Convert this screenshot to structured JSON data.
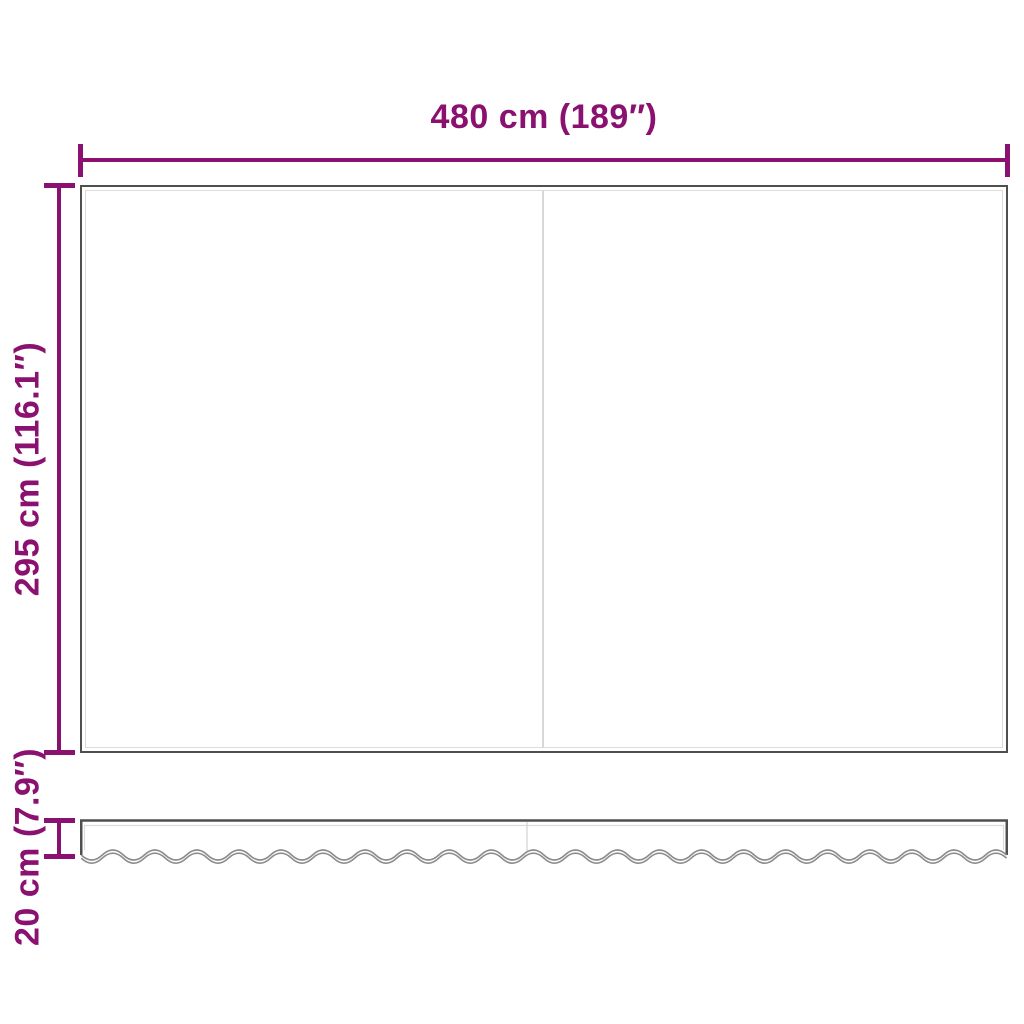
{
  "colors": {
    "accent": "#8a116f",
    "outline": "#4f4f4f",
    "inner_line": "#dcdcdc",
    "seam": "#d8d8d8",
    "wave": "#8c8c8c",
    "background": "#ffffff"
  },
  "labels": {
    "width": "480 cm (189″)",
    "height": "295 cm (116.1″)",
    "valance_height": "20 cm (7.9″)"
  }
}
